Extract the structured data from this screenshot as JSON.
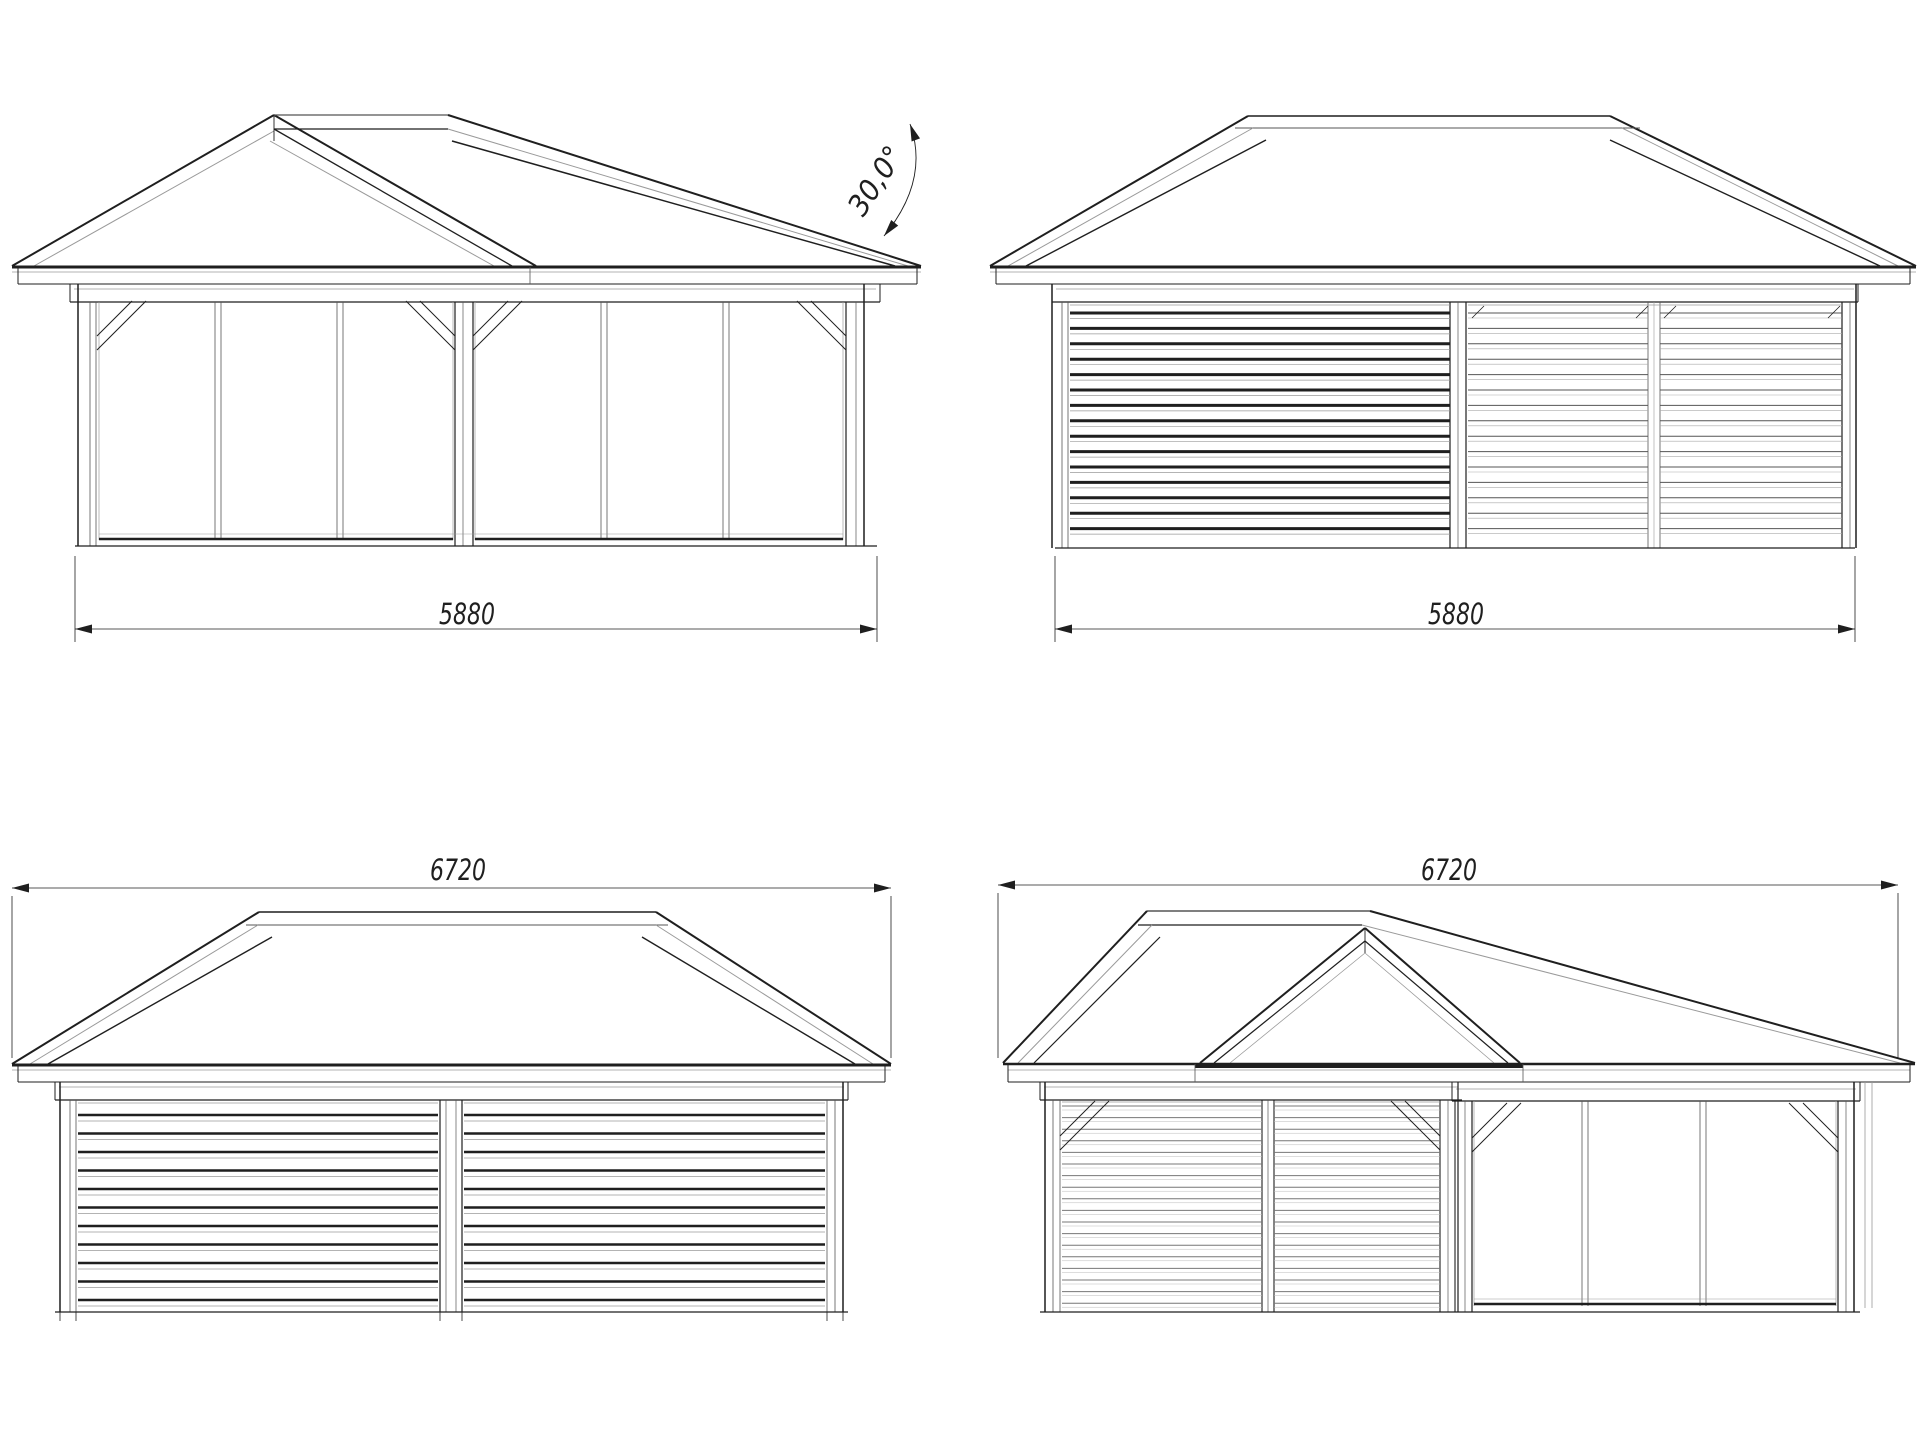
{
  "document": {
    "background_color": "#ffffff",
    "line_color": "#1f1f1f",
    "medium_line_color": "#555555",
    "light_line_color": "#9a9a9a"
  },
  "views": {
    "front": {
      "dimension": "5880",
      "roof_angle": "30,0°"
    },
    "side_a": {
      "dimension": "5880"
    },
    "rear": {
      "dimension": "6720"
    },
    "side_b": {
      "dimension": "6720"
    }
  }
}
